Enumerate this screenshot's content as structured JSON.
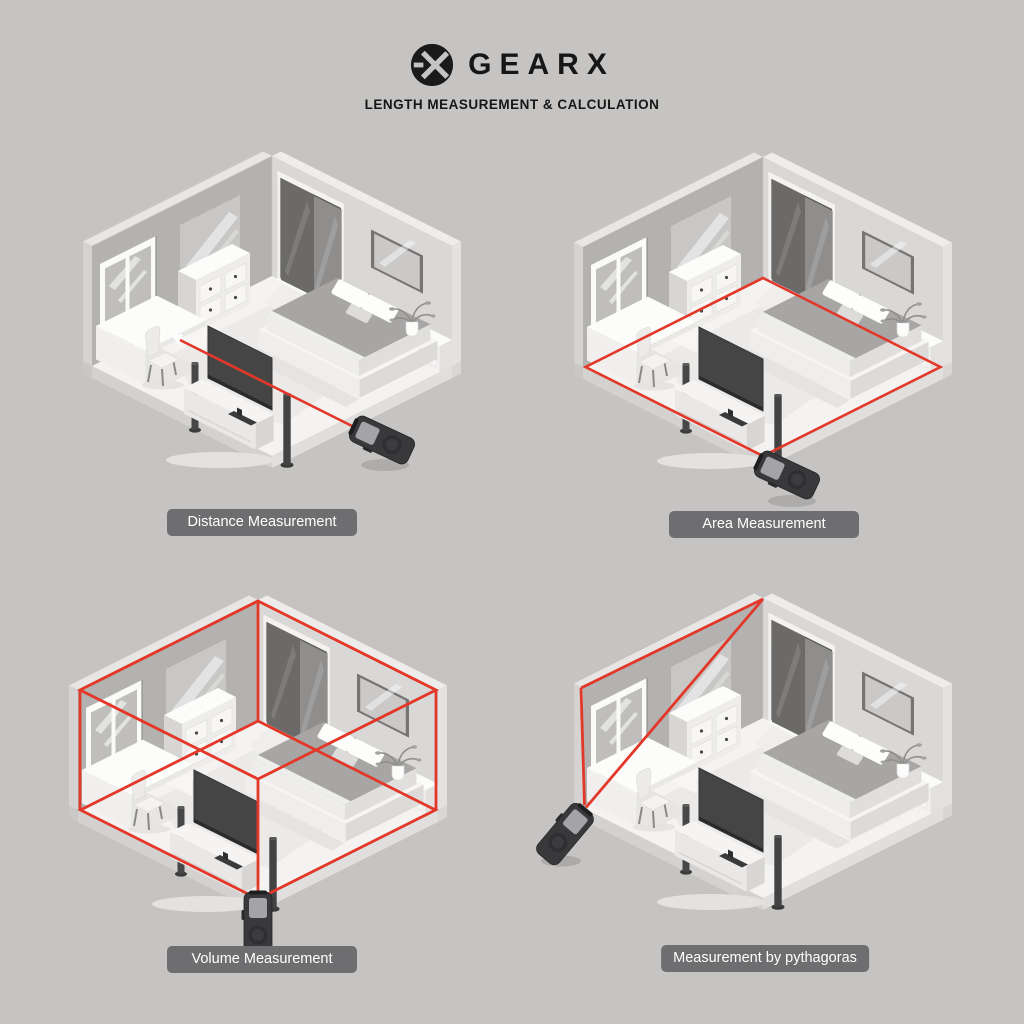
{
  "header": {
    "brand": "GEARX",
    "subtitle": "LENGTH MEASUREMENT & CALCULATION",
    "logo_icon": "gearx-circle-monogram-icon"
  },
  "panels": [
    {
      "id": "distance",
      "label": "Distance Measurement",
      "laser_mode": "single line across room"
    },
    {
      "id": "area",
      "label": "Area Measurement",
      "laser_mode": "floor perimeter outline"
    },
    {
      "id": "volume",
      "label": "Volume Measurement",
      "laser_mode": "full room box wireframe"
    },
    {
      "id": "pythagoras",
      "label": "Measurement by pythagoras",
      "laser_mode": "wall triangle (height + diagonal)"
    }
  ],
  "colors": {
    "background": "#c5c4c3",
    "laser_red": "#e2382a",
    "label_bg": "#6e6e70",
    "label_text": "#ffffff",
    "header_text": "#161616",
    "wall_left": "#b3b2b1",
    "wall_right": "#d9d8d7",
    "floor": "#f4f3f2",
    "device_body": "#39393b"
  }
}
